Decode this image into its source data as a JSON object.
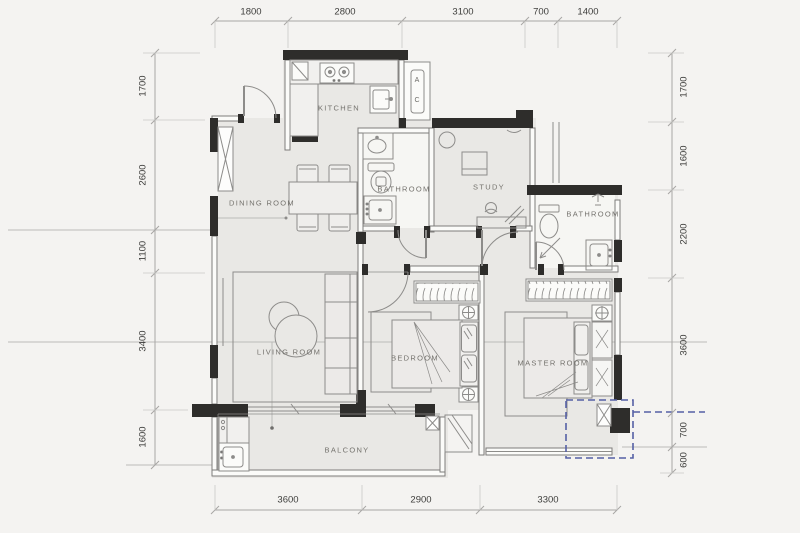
{
  "plan": {
    "rooms": {
      "kitchen": "KITCHEN",
      "dining": "DINING ROOM",
      "bathroom_small": "BATHROOM",
      "study": "STUDY",
      "bathroom_master": "BATHROOM",
      "living": "LIVING ROOM",
      "bedroom": "BEDROOM",
      "master": "MASTER ROOM",
      "balcony": "BALCONY"
    },
    "labels": {
      "ac_shaft": "A C"
    }
  },
  "dimensions": {
    "top": [
      "1800",
      "2800",
      "3100",
      "700",
      "1400"
    ],
    "left": [
      "1700",
      "2600",
      "1100",
      "3400",
      "1600"
    ],
    "right": [
      "1700",
      "1600",
      "2200",
      "3600",
      "700",
      "600"
    ],
    "bottom": [
      "3600",
      "2900",
      "3300"
    ]
  },
  "colors": {
    "background": "#f4f3f1",
    "floor": "#e9e8e5",
    "wall": "#2e2d2b",
    "furniture_line": "#8d8c8a",
    "dimension_line": "#a8a7a5",
    "highlight_dashed_box": "#5560a5"
  }
}
